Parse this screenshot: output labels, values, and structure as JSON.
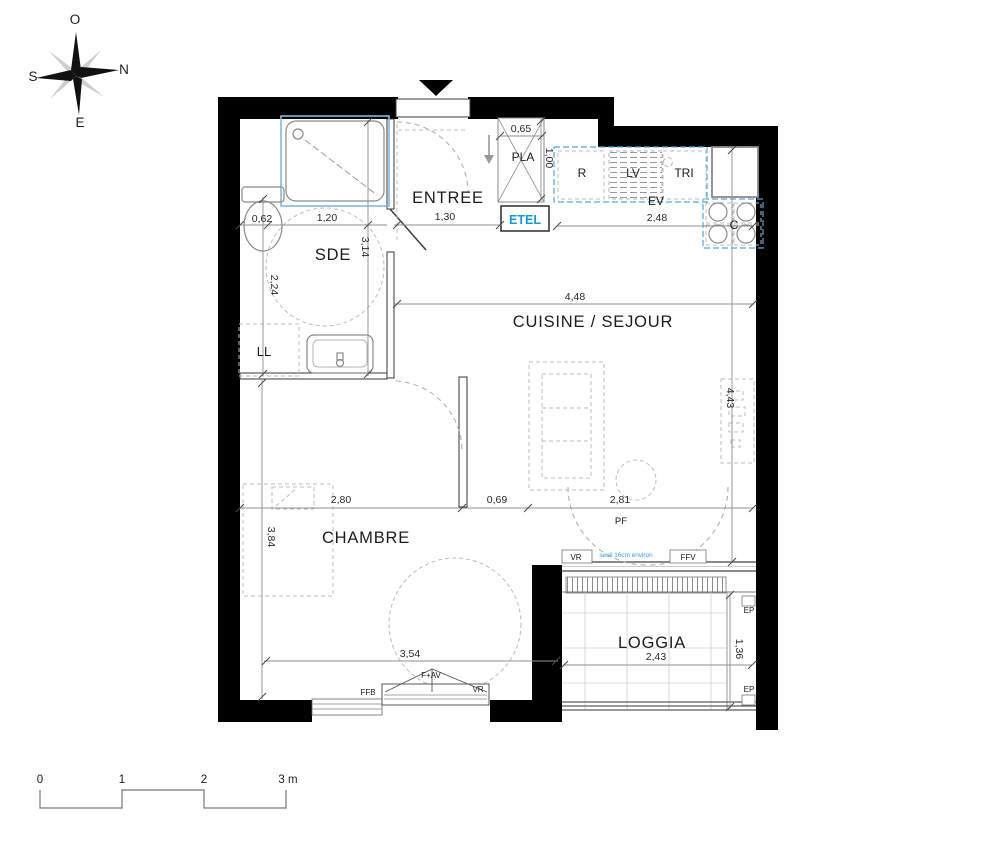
{
  "title": "Plan d'appartement 2 pièces",
  "compass": {
    "top": "O",
    "right": "N",
    "left": "S",
    "bottom": "E"
  },
  "rooms": {
    "entree": "ENTREE",
    "sde": "SDE",
    "cuisine_sejour": "CUISINE / SEJOUR",
    "chambre": "CHAMBRE",
    "loggia": "LOGGIA"
  },
  "labels": {
    "placard": "PLA",
    "tableau_electrique": "ETEL",
    "refrigerateur": "R",
    "lave_vaisselle": "LV",
    "tri": "TRI",
    "evier": "EV",
    "cuisson": "C",
    "lave_linge": "LL",
    "porte_fenetre": "PF",
    "volet_roulant": "VR",
    "fenetre_ffv": "FFV",
    "fenetre_ffb": "FFB",
    "fenetre_f_av": "F+AV",
    "evacuation_ep": "EP",
    "seuil_note": "seuil 16cm environ"
  },
  "dimensions": {
    "placard_width": "0,65",
    "placard_depth": "1,00",
    "entree_width": "1,30",
    "wc_width": "0,62",
    "sde_width": "1,20",
    "sde_length": "3,14",
    "sde_left_height": "2,24",
    "sejour_width": "4,48",
    "plan_travail": "2,48",
    "sejour_depth": "4,43",
    "chambre_width": "2,80",
    "degagement": "0,69",
    "baie_width": "2,81",
    "chambre_depth": "3,84",
    "chambre_facade": "3,54",
    "loggia_width": "2,43",
    "loggia_depth": "1,36"
  },
  "scale_bar": {
    "t0": "0",
    "t1": "1",
    "t2": "2",
    "t3": "3 m"
  },
  "colors": {
    "wall": "#000000",
    "kitchen_dash_blue": "#52a7e0",
    "shower_blue": "#84b8e2",
    "etel_blue": "#1899d6",
    "seuil_blue": "#2f9fdc"
  }
}
